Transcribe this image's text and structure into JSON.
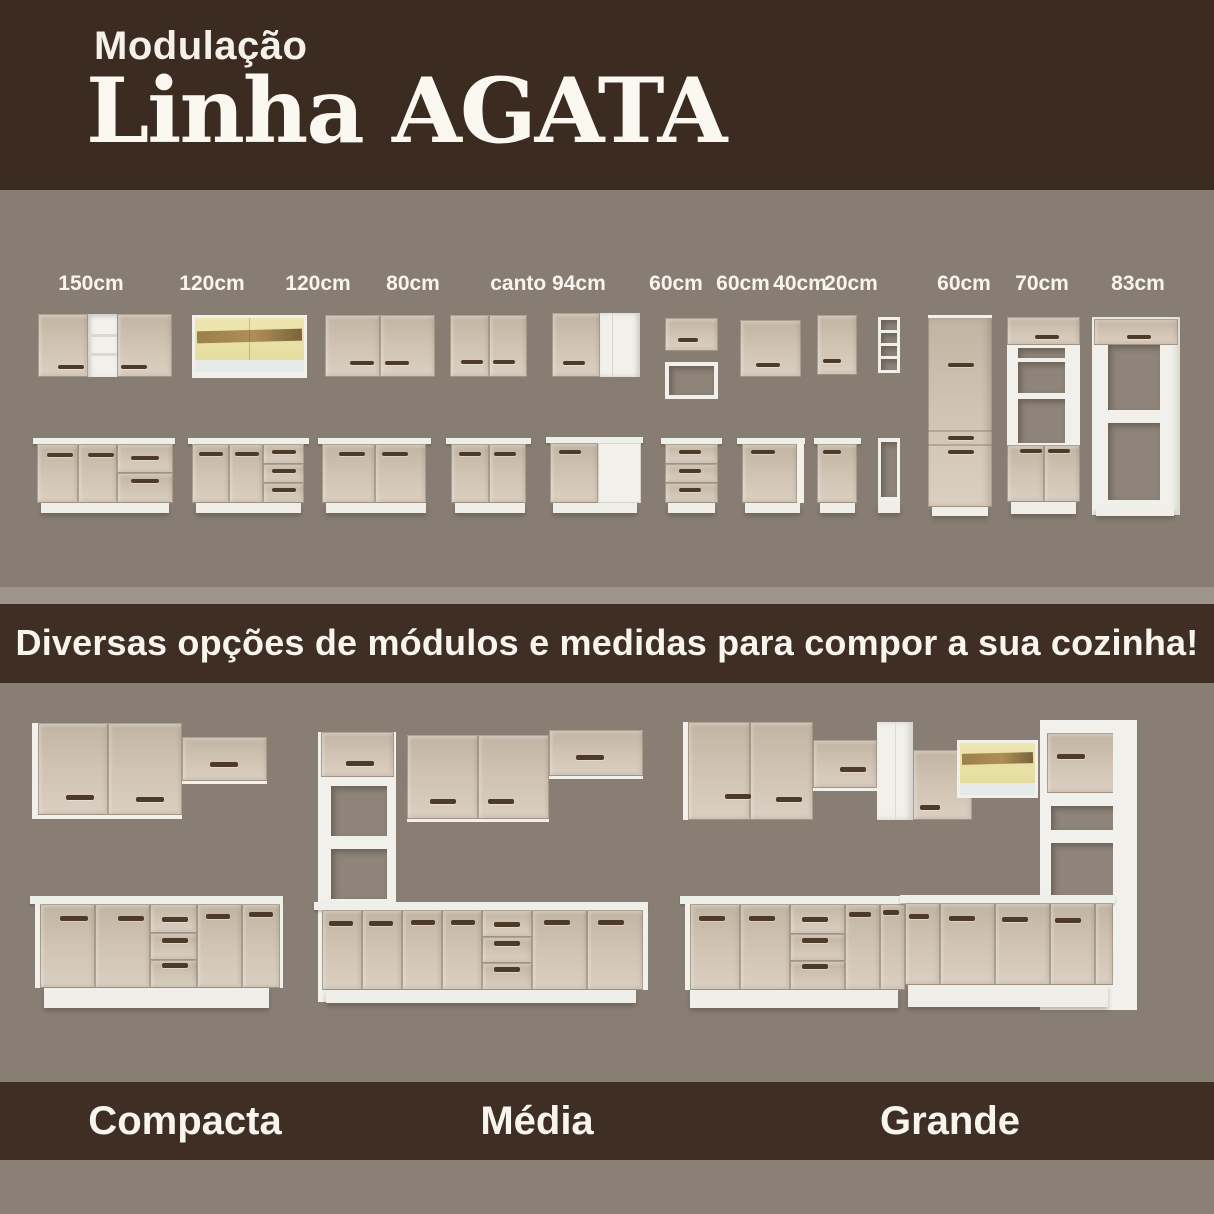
{
  "header": {
    "kicker": "Modulação",
    "title": "Linha AGATA"
  },
  "module_sizes": [
    "150cm",
    "120cm",
    "120cm",
    "80cm",
    "canto 94cm",
    "60cm",
    "60cm",
    "40cm",
    "20cm",
    "60cm",
    "70cm",
    "83cm"
  ],
  "banner": {
    "text": "Diversas opções de módulos e medidas para compor a sua cozinha!"
  },
  "kitchens": [
    {
      "name": "Compacta"
    },
    {
      "name": "Média"
    },
    {
      "name": "Grande"
    }
  ],
  "colors": {
    "brown": "#3b2b21",
    "background_gray": "#877d73",
    "strip_gray": "#9d948a",
    "door_beige": "#cfc2b2",
    "carcass_white": "#f1f0ea",
    "handle_brown": "#4d3a29",
    "glass_yellow": "#eae2a8"
  }
}
